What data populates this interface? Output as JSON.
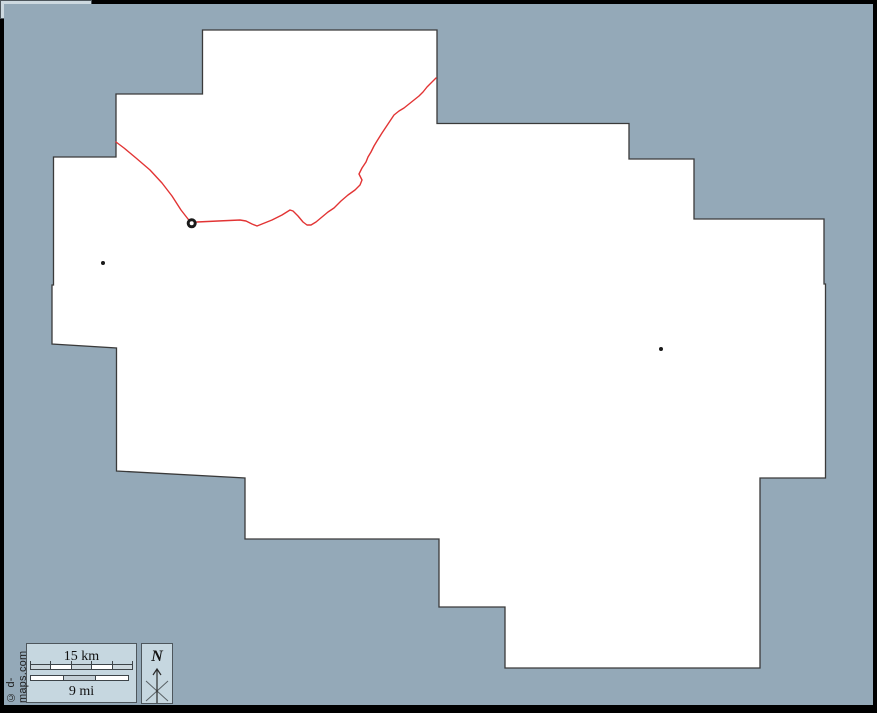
{
  "credit": "© d-maps.com",
  "map": {
    "sea_color": "#94a9b8",
    "land_color": "#ffffff",
    "outline_color": "#3a3a3a",
    "river_color": "#e23434",
    "marker_color": "#1a1a1a",
    "outline_points": "202.5,30 437,30 437,123.5 629,123.5 629,159 694,159 694,219 824,219 824,284 825.5,284 825.5,478 760,478 760,668 505,668 505,607 439,607 439,539 245,539 245,478 116.5,471 116.5,348 52,344 52,285 53.5,285 53.5,157 116,157 116,94 202.5,94",
    "river_points": "116,142 124,148 136,158 150,170 162,183 172,196 181,210 188,219 191.7,223.3 197,222 218,221 240,220 246,221 252,224 257,226 262,224 272,220 282,215 290,210 293,211 298,216 303,222 307,225 311,225 316,222 322,217 328,212 334,208 341,201 348,195 355,190 360,185 362,180 359,174 362,168 366,162 368,157 371,152 374,146 377,141 382,133 386,127 390,121 394,115 399,111 404,108 409,104 414,100 419,96 423,92 427,87 431,83 436,78",
    "city_ring": {
      "x": 191.7,
      "y": 223.3
    },
    "dots": [
      {
        "x": 103,
        "y": 263
      },
      {
        "x": 661,
        "y": 349
      }
    ]
  },
  "scale_bar": {
    "km_label": "15 km",
    "mi_label": "9 mi",
    "km_pattern": [
      "#cdd8de",
      "#ffffff",
      "#cdd8de",
      "#ffffff",
      "#cdd8de"
    ],
    "mi_pattern": [
      "#ffffff",
      "#c3cfd6",
      "#ffffff"
    ]
  },
  "compass": {
    "label": "N"
  },
  "projection": {
    "label": "Mercator"
  }
}
